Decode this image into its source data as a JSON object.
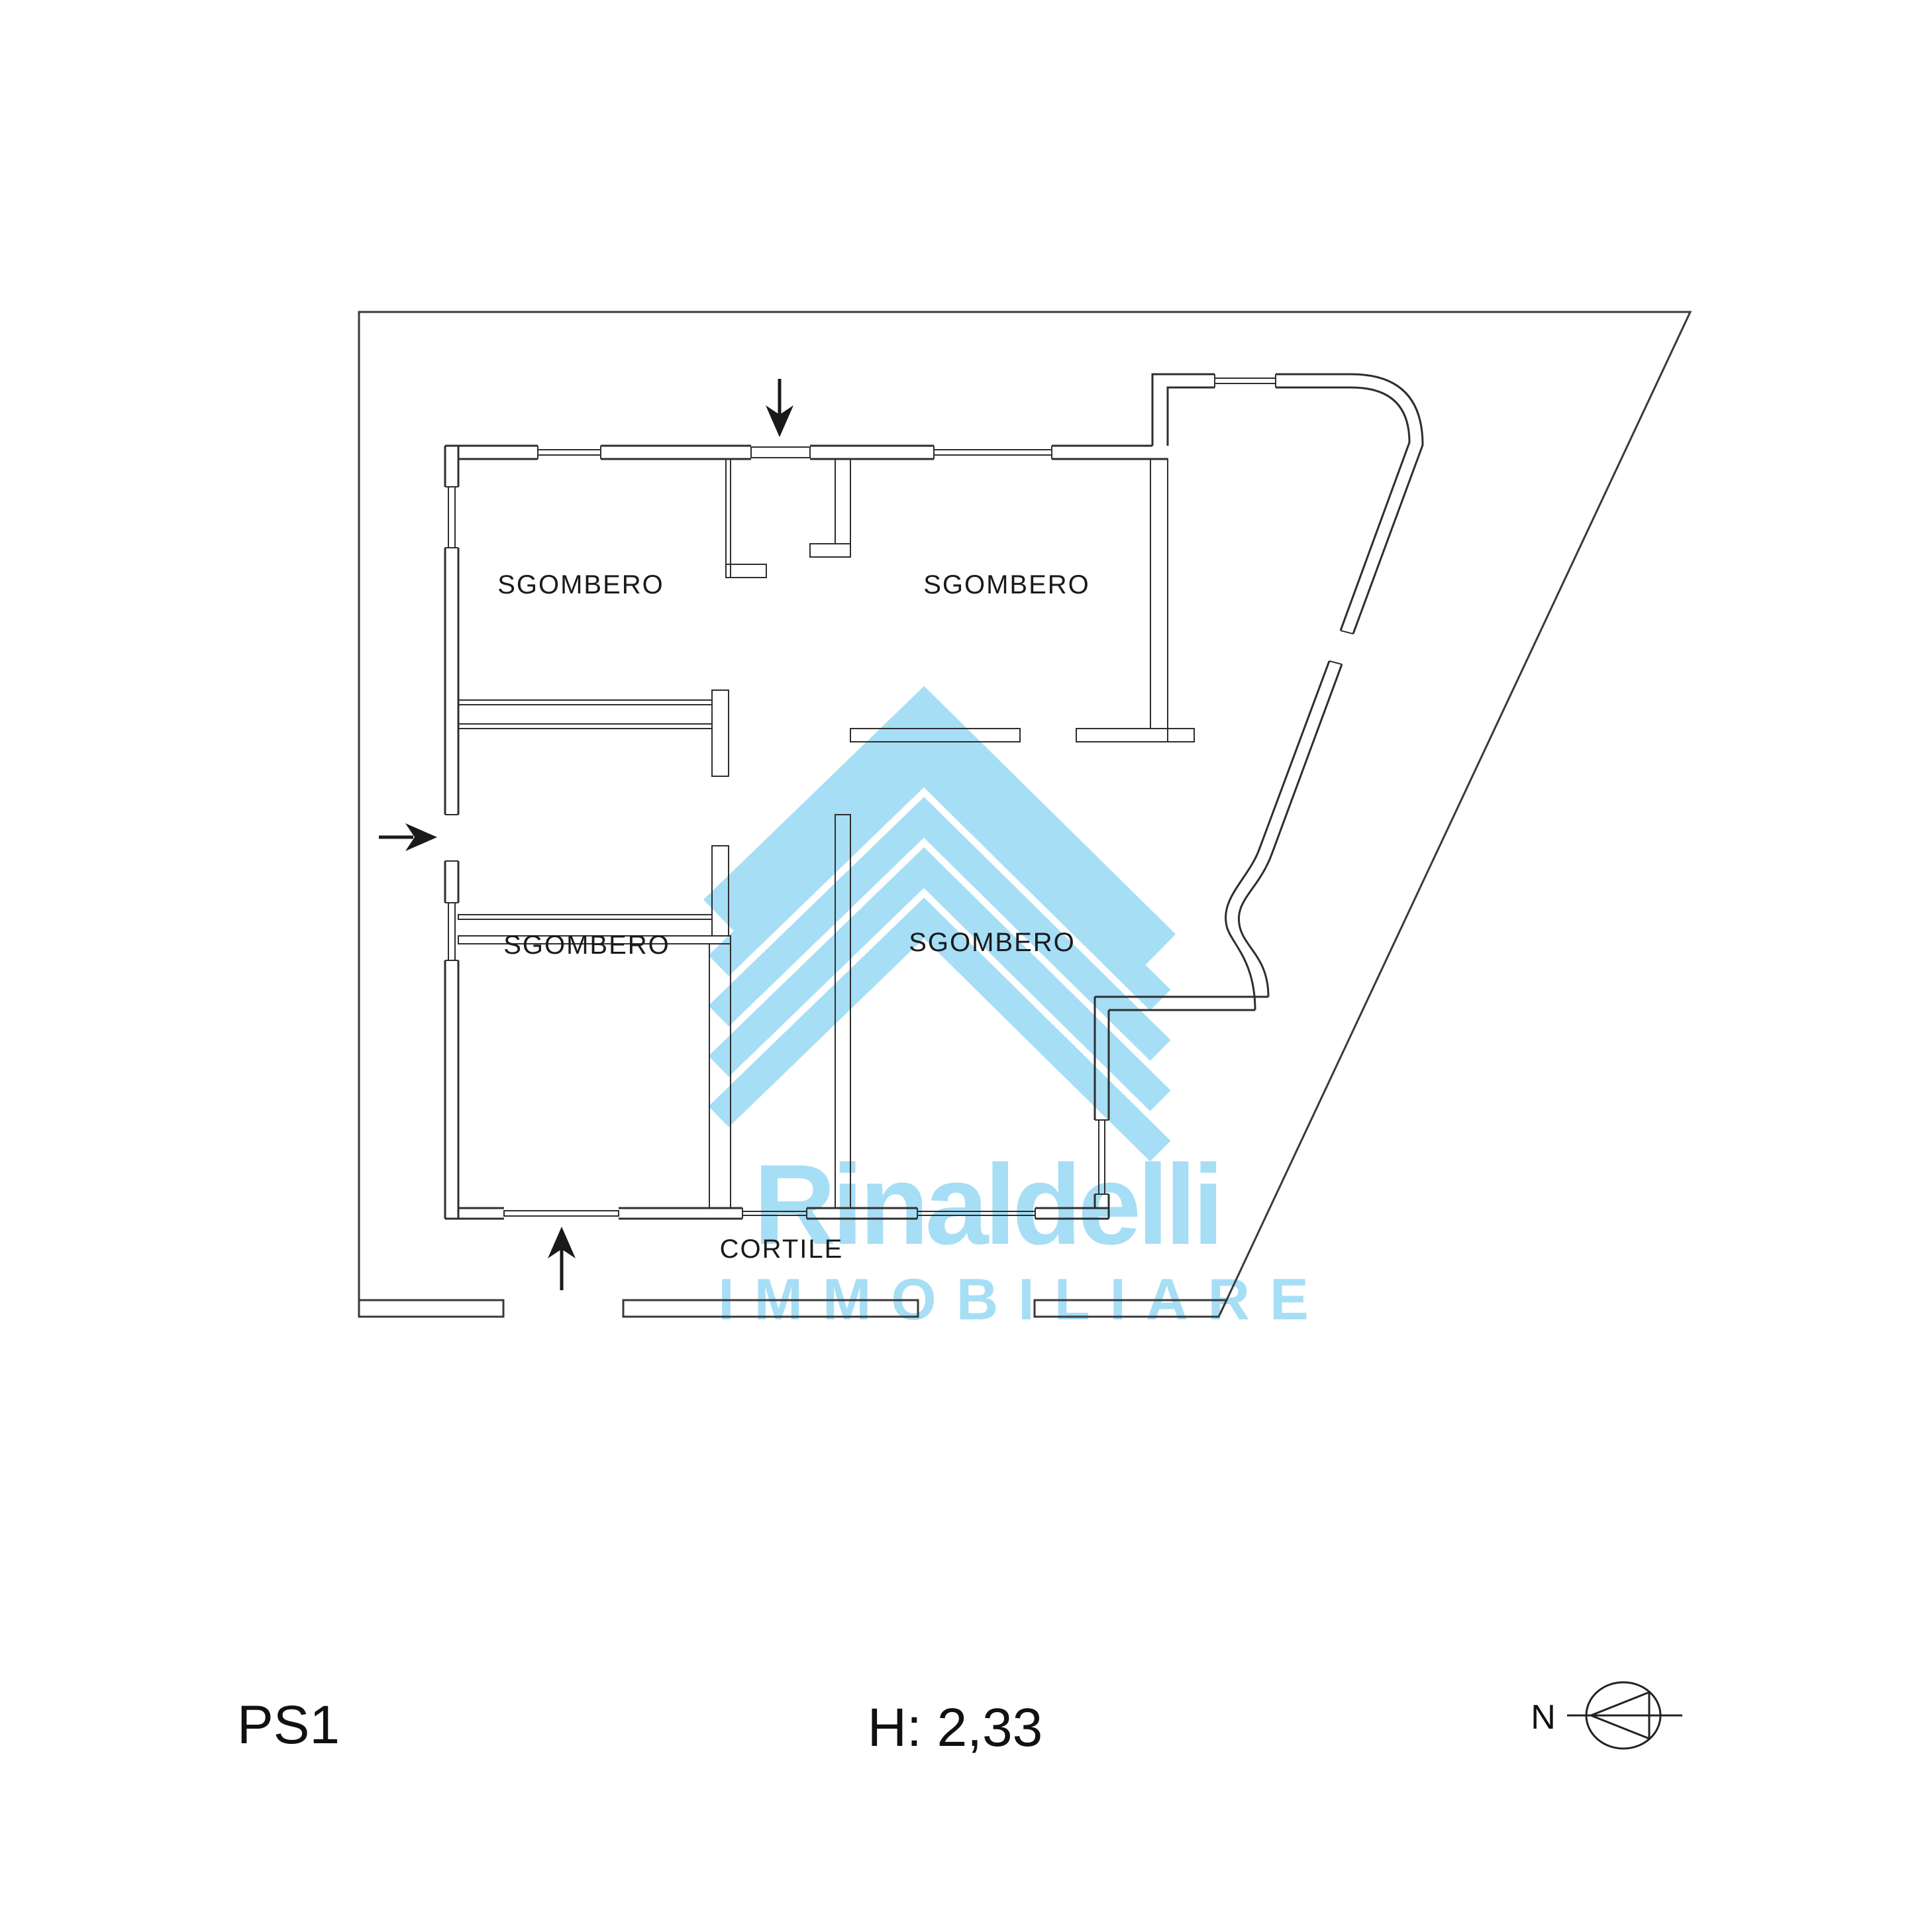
{
  "plan": {
    "room_labels": [
      {
        "text": "SGOMBERO"
      },
      {
        "text": "SGOMBERO"
      },
      {
        "text": "SGOMBERO"
      },
      {
        "text": "SGOMBERO"
      }
    ],
    "area_label": {
      "text": "CORTILE"
    }
  },
  "watermark": {
    "brand": "Rinaldelli",
    "tagline": "IMMOBILIARE",
    "color": "#a6def5"
  },
  "footer": {
    "floor": "PS1",
    "height": "H: 2,33"
  },
  "compass": {
    "label": "N"
  },
  "colors": {
    "line": "#2e2e2e",
    "text": "#1a1a1a",
    "watermark": "#a6def5",
    "background": "#ffffff"
  }
}
